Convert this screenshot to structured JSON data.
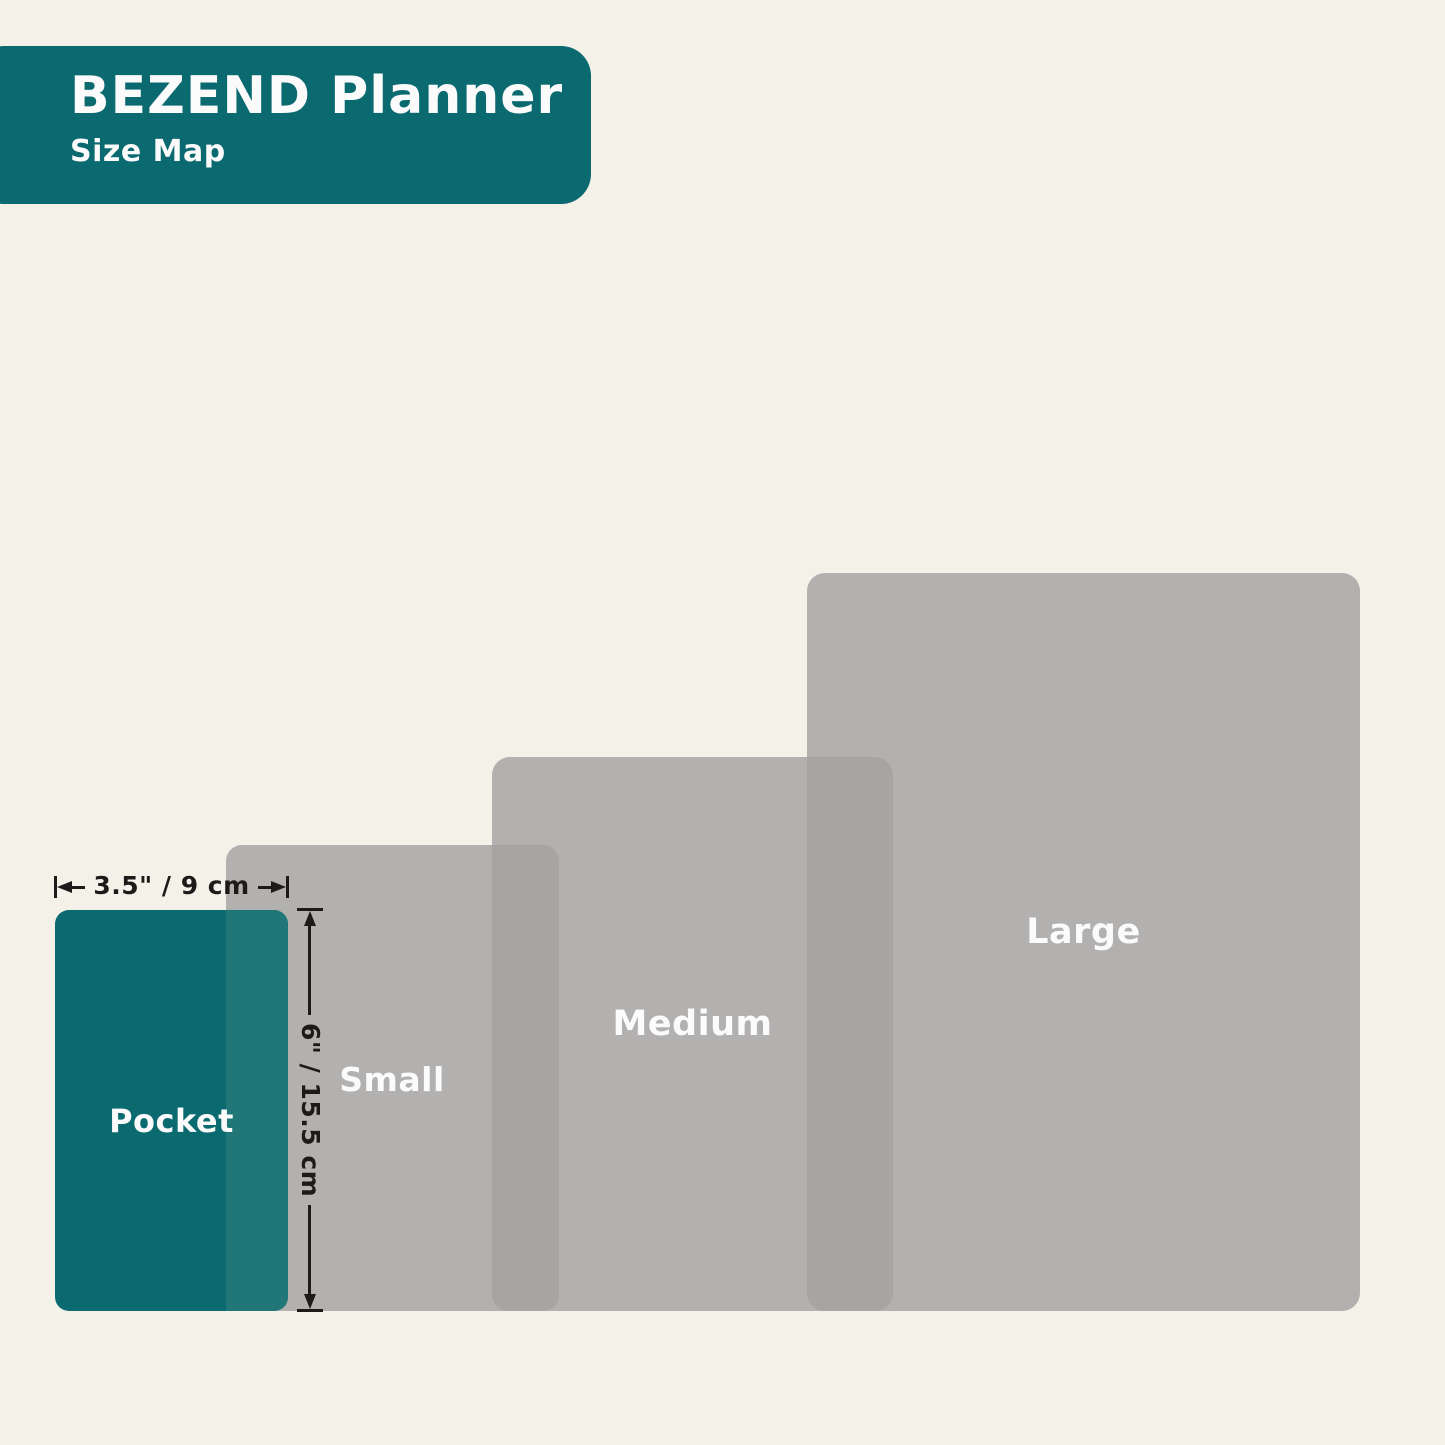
{
  "header": {
    "title": "BEZEND Planner",
    "subtitle": "Size Map"
  },
  "sizes": [
    {
      "label": "Pocket",
      "highlighted": true
    },
    {
      "label": "Small",
      "highlighted": false
    },
    {
      "label": "Medium",
      "highlighted": false
    },
    {
      "label": "Large",
      "highlighted": false
    }
  ],
  "dimensions": {
    "width_label": "3.5\" / 9 cm",
    "height_label": "6\" / 15.5 cm"
  },
  "colors": {
    "background": "#f4f1e9",
    "teal": "#0a6a70",
    "teal_overlap": "#217678",
    "gray": "#b3b0b0",
    "gray_overlap": "#a7a4a4",
    "annotation": "#1d1b1a",
    "label_text": "#fbfbfb"
  }
}
